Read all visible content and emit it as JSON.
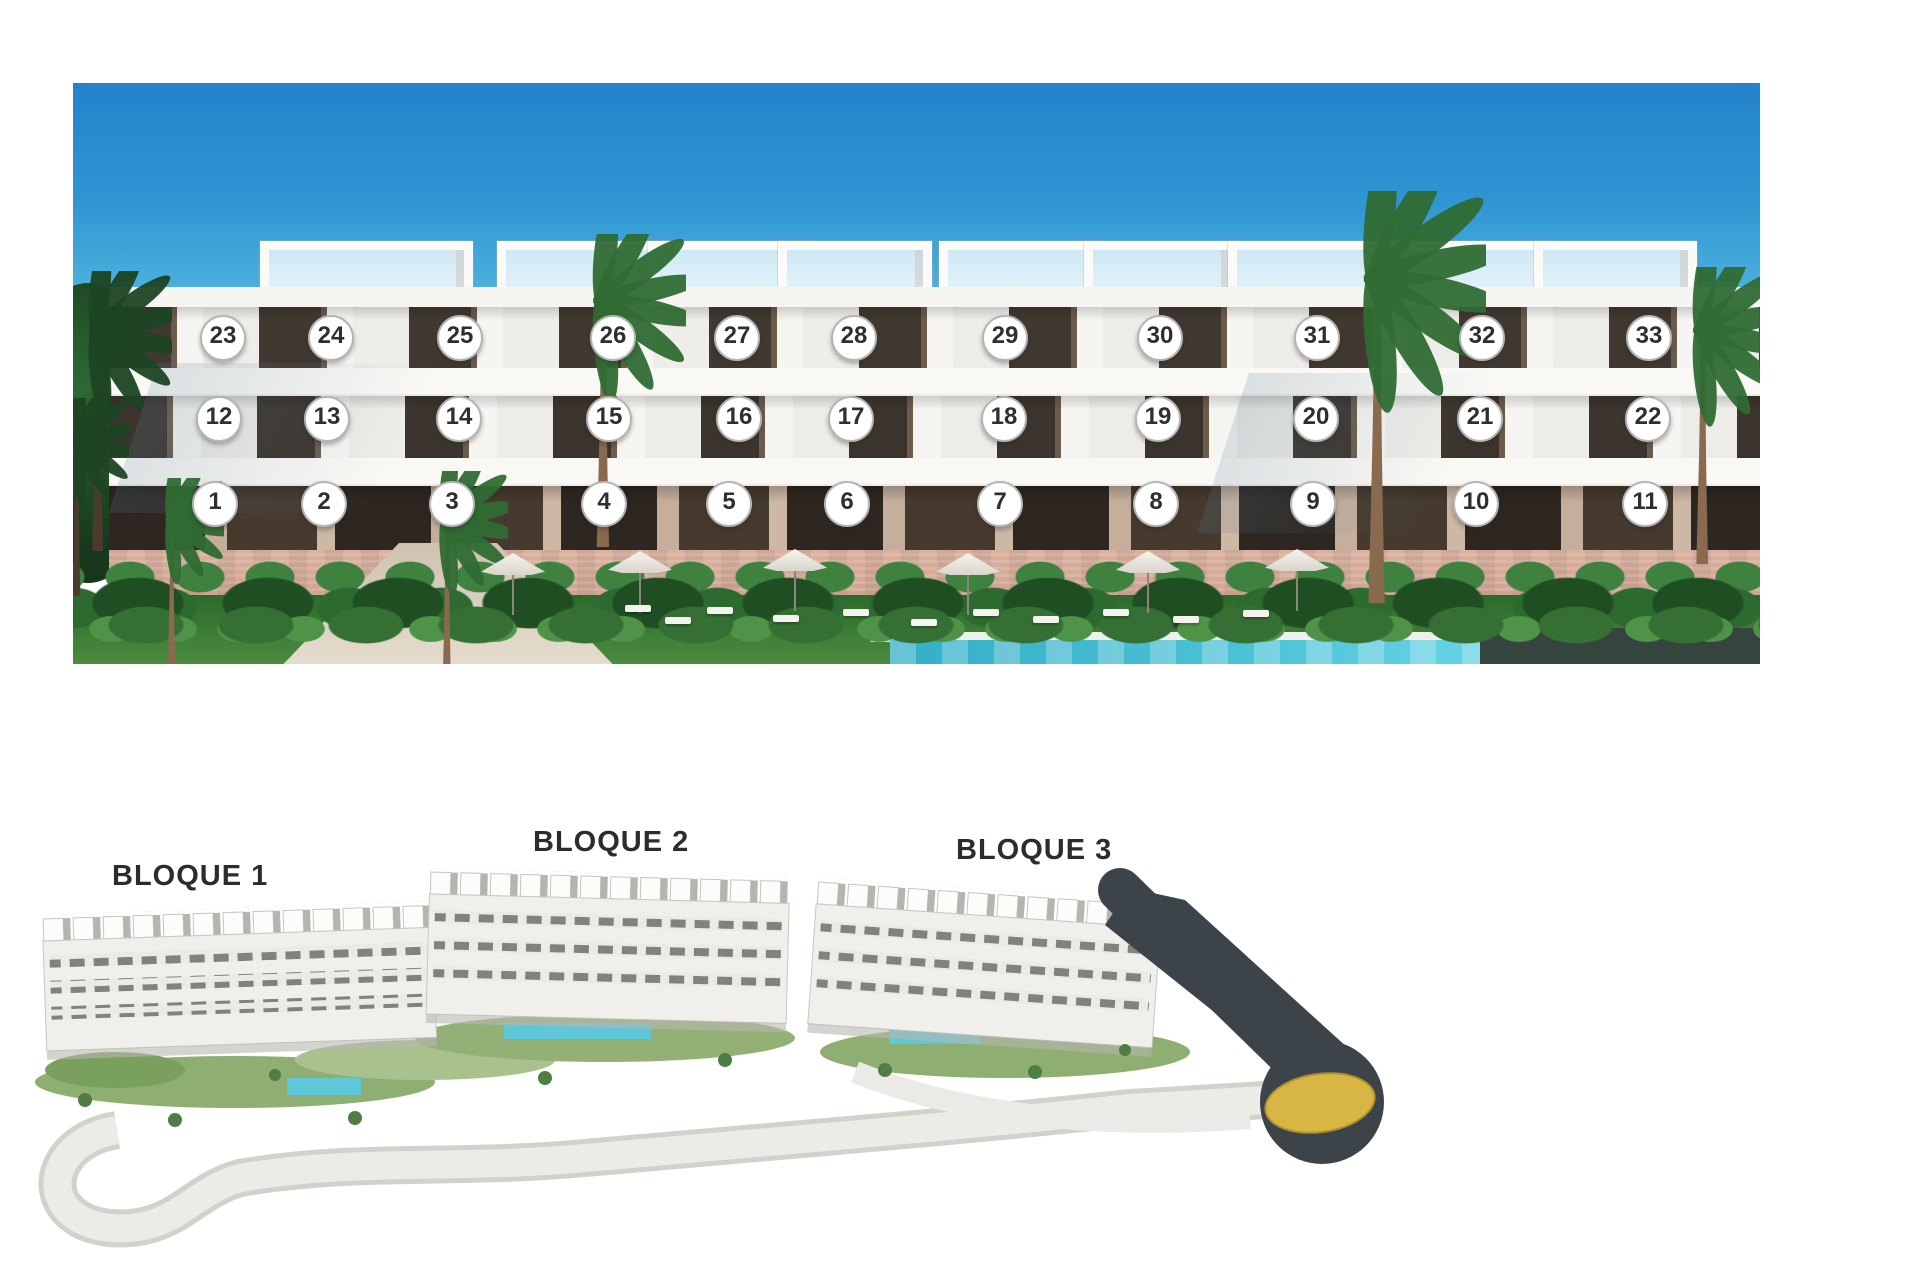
{
  "elevation": {
    "description": "Front elevation render of a white three-storey apartment building with numbered unit markers",
    "rows": [
      {
        "id": "top-floor",
        "y": 336,
        "units": [
          [
            23,
            221
          ],
          [
            24,
            329
          ],
          [
            25,
            458
          ],
          [
            26,
            611
          ],
          [
            27,
            735
          ],
          [
            28,
            852
          ],
          [
            29,
            1003
          ],
          [
            30,
            1158
          ],
          [
            31,
            1315
          ],
          [
            32,
            1480
          ],
          [
            33,
            1647
          ]
        ]
      },
      {
        "id": "middle-floor",
        "y": 417,
        "units": [
          [
            12,
            217
          ],
          [
            13,
            325
          ],
          [
            14,
            457
          ],
          [
            15,
            607
          ],
          [
            16,
            737
          ],
          [
            17,
            849
          ],
          [
            18,
            1002
          ],
          [
            19,
            1156
          ],
          [
            20,
            1314
          ],
          [
            21,
            1478
          ],
          [
            22,
            1646
          ]
        ]
      },
      {
        "id": "ground-floor",
        "y": 502,
        "units": [
          [
            1,
            213
          ],
          [
            2,
            322
          ],
          [
            3,
            450
          ],
          [
            4,
            602
          ],
          [
            5,
            727
          ],
          [
            6,
            845
          ],
          [
            7,
            998
          ],
          [
            8,
            1154
          ],
          [
            9,
            1311
          ],
          [
            10,
            1474
          ],
          [
            11,
            1643
          ]
        ]
      }
    ]
  },
  "site_plan": {
    "description": "Aerial site plan of the development with three blocks and access road with roundabout",
    "labels": [
      {
        "text": "BLOQUE 1",
        "x": 112,
        "y": 860
      },
      {
        "text": "BLOQUE 2",
        "x": 533,
        "y": 826
      },
      {
        "text": "BLOQUE 3",
        "x": 956,
        "y": 834
      }
    ]
  },
  "colors": {
    "sky_top": "#2383cb",
    "sky_mid": "#51b5de",
    "building_white": "#f6f5f2",
    "window_dark": "#413931",
    "stone_base": "#cda08f",
    "lawn_green": "#4b8c3f",
    "pool_teal": "#4cc2d6",
    "road_dark": "#3d4449",
    "roundabout_gold": "#d8b643",
    "marker_border": "#b5b5b5",
    "marker_text": "#2f2f2f",
    "label_text": "#2c2c2c"
  }
}
